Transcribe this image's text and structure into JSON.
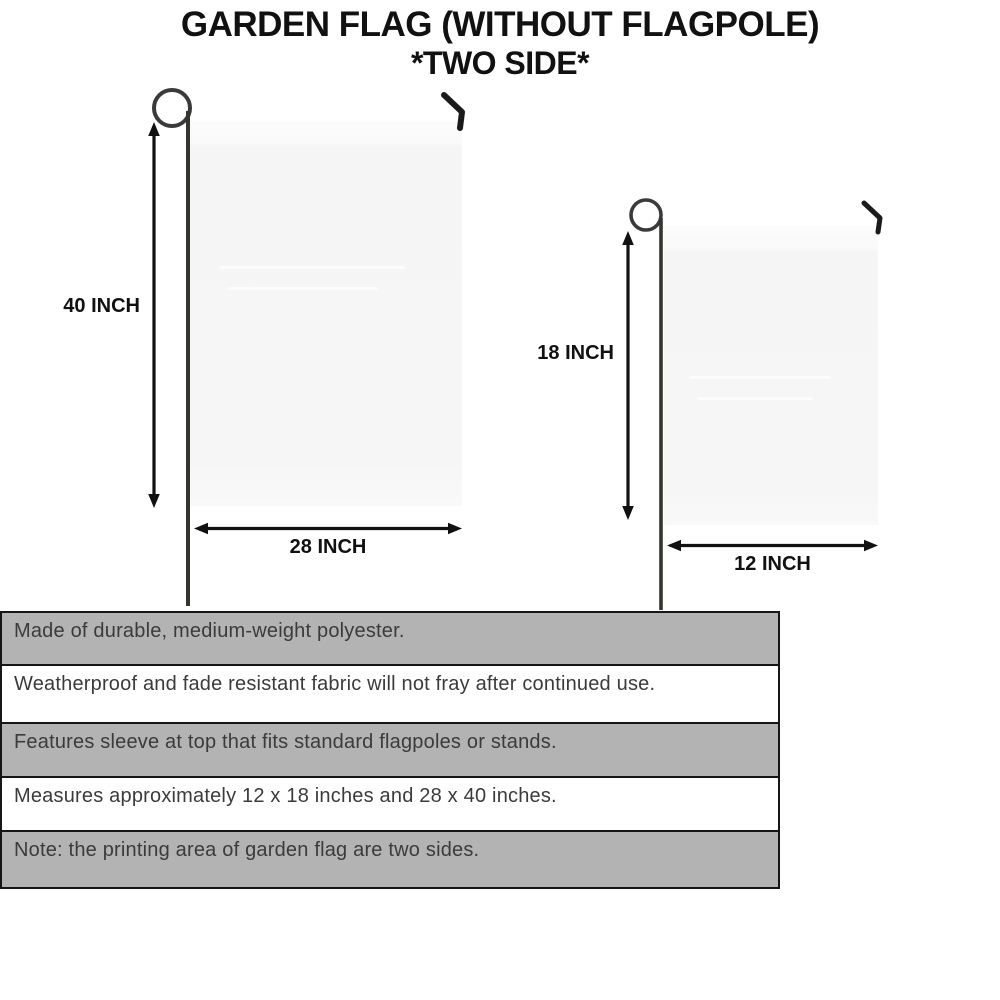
{
  "title": {
    "line1": "GARDEN FLAG (WITHOUT FLAGPOLE)",
    "line2": "*TWO SIDE*"
  },
  "diagram": {
    "large_flag": {
      "height_label": "40 INCH",
      "width_label": "28 INCH"
    },
    "small_flag": {
      "height_label": "18 INCH",
      "width_label": "12 INCH"
    }
  },
  "features": {
    "rows": [
      {
        "text": "Made of durable, medium-weight polyester.",
        "shaded": true
      },
      {
        "text": "Weatherproof and fade resistant fabric will not fray after continued use.",
        "shaded": false
      },
      {
        "text": "Features sleeve at top that fits standard flagpoles or stands.",
        "shaded": true
      },
      {
        "text": "Measures approximately 12 x 18 inches and 28 x 40 inches.",
        "shaded": false
      },
      {
        "text": "Note: the printing area of garden flag are two sides.",
        "shaded": true
      }
    ]
  },
  "colors": {
    "title_color": "#111111",
    "band_gray": "#b3b3b3",
    "band_border": "#161616",
    "flag_fill": "#f6f6f6",
    "pole_color": "#3a3a3a",
    "arrow_color": "#111111",
    "feature_text": "#3b3b3b"
  }
}
